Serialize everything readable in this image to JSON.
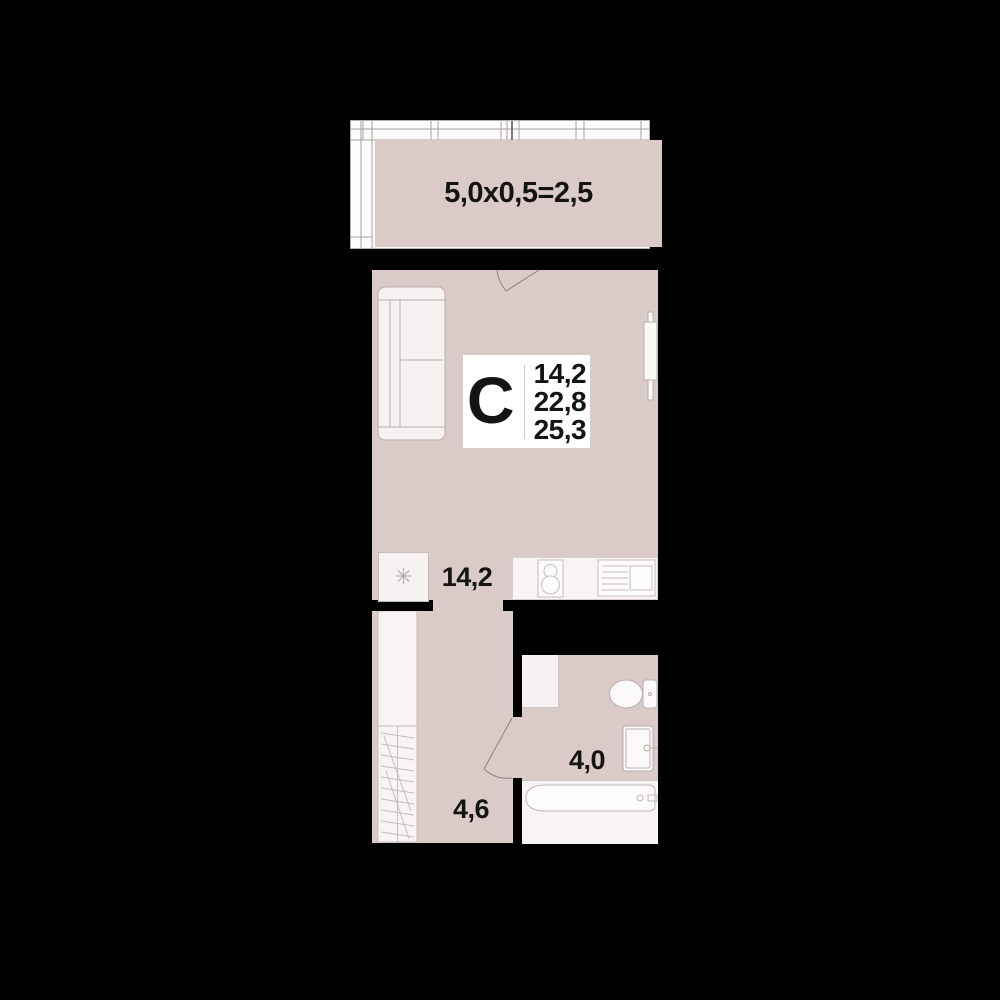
{
  "colors": {
    "background": "#000000",
    "room_fill": "#dacac8",
    "fixture_fill": "#f7f2f1",
    "fixture_stroke": "#b9aeae",
    "text": "#141414",
    "badge_bg": "#ffffff"
  },
  "balcony": {
    "area_label": "5,0x0,5=2,5"
  },
  "studio_badge": {
    "room_type_letter": "С",
    "areas": [
      "14,2",
      "22,8",
      "25,3"
    ]
  },
  "rooms": {
    "kitchen_living": {
      "area_label": "14,2"
    },
    "hallway": {
      "area_label": "4,6"
    },
    "bathroom": {
      "area_label": "4,0"
    }
  },
  "icons": {
    "fridge_snowflake": "✳"
  }
}
